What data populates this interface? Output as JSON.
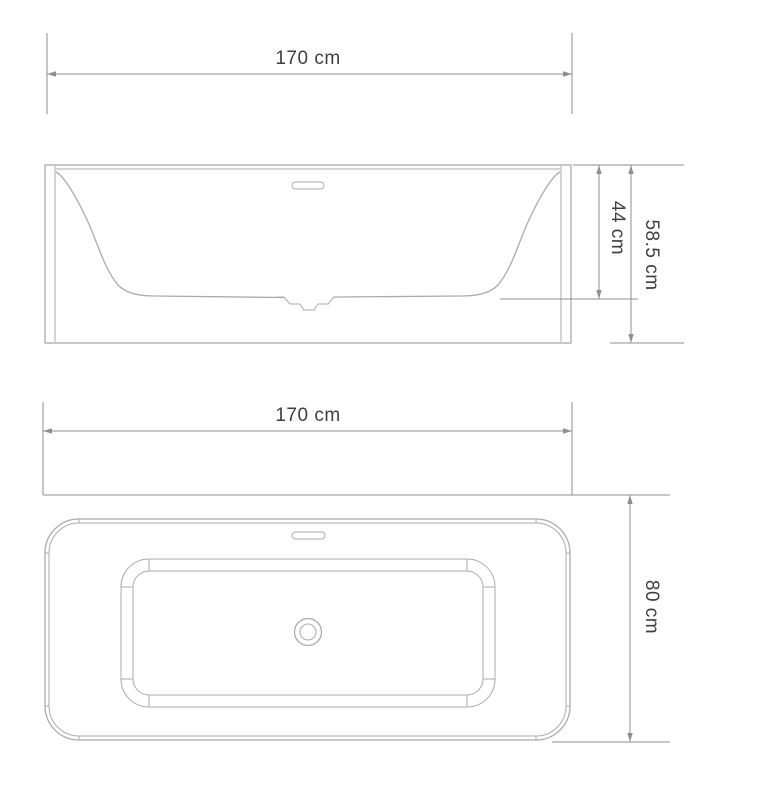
{
  "drawing": {
    "subject": "bathtub-dimension-drawing",
    "labels": {
      "front_width": "170 cm",
      "inner_depth": "44 cm",
      "overall_height": "58.5 cm",
      "top_width": "170 cm",
      "top_depth": "80 cm"
    },
    "values": {
      "front_width_cm": 170,
      "inner_depth_cm": 44,
      "overall_height_cm": 58.5,
      "top_width_cm": 170,
      "top_depth_cm": 80
    },
    "colors": {
      "drawing_line": "#ababab",
      "dimension_line": "#8f8f8f",
      "text": "#3f3f3f",
      "background": "#ffffff"
    }
  }
}
